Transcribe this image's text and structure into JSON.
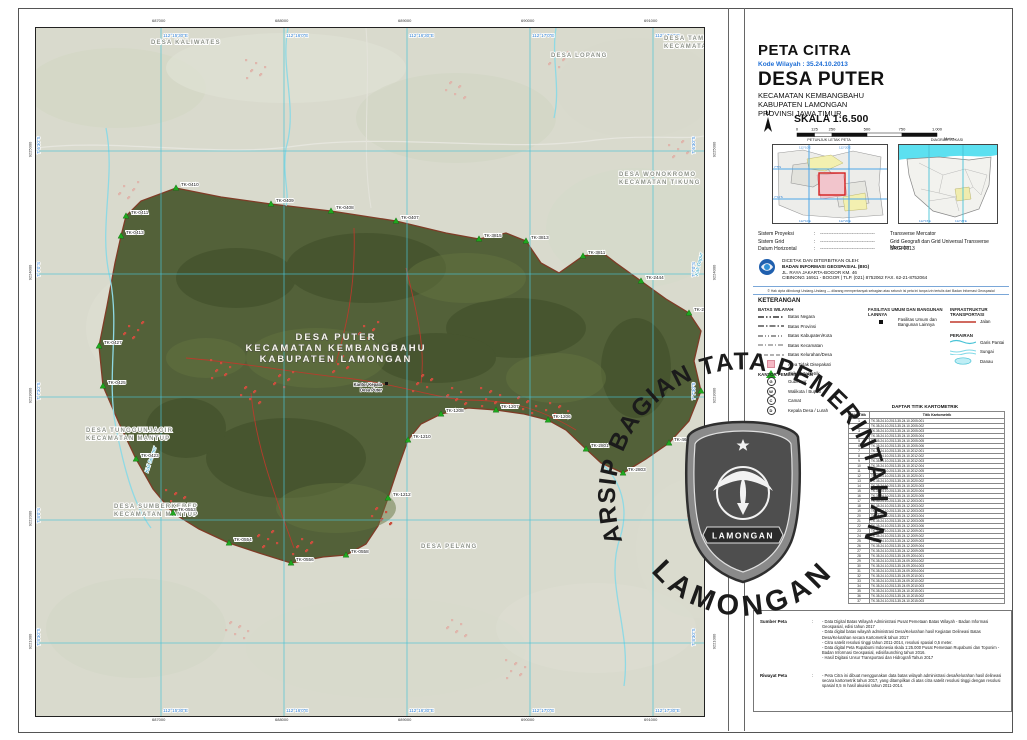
{
  "title_block": {
    "map_type": "PETA CITRA",
    "kode_wilayah": "Kode Wilayah : 35.24.10.2013",
    "village": "DESA PUTER",
    "admin1": "KECAMATAN KEMBANGBAHU",
    "admin2": "KABUPATEN LAMONGAN",
    "admin3": "PROVINSI JAWA TIMUR",
    "north_label": "U",
    "scale_label": "SKALA  1:6.500",
    "scale_unit": "Meter",
    "scale_values": [
      "0",
      "125",
      "250",
      "500",
      "750",
      "1.000"
    ]
  },
  "insets": {
    "left_caption": "PETUNJUK LETAK PETA",
    "right_caption": "DIAGRAM LOKASI"
  },
  "projection": [
    {
      "label": "Sistem Proyeksi",
      "value": "Transverse Mercator"
    },
    {
      "label": "Sistem Grid",
      "value": "Grid Geografi dan Grid Universal Transverse Mercator"
    },
    {
      "label": "Datum Horizontal",
      "value": "SRGI 2013"
    }
  ],
  "publisher": {
    "line1": "DICETAK DAN DITERBITKAN OLEH:",
    "line2": "BADAN INFORMASI GEOSPASIAL (BIG)",
    "line3": "JL. RAYA JAKARTA-BOGOR KM. 46",
    "line4": "CIBINONG 16911 - BOGOR | TLP. (021) 8752062  FAX. 62-21-8752064",
    "copyright": "© Hak cipta dilindungi Undang-Undang — dilarang memperbanyak sebagian atau seluruh isi peta ini tanpa izin tertulis dari Badan Informasi Geospasial"
  },
  "legend": {
    "title": "KETERANGAN",
    "batas_title": "BATAS WILAYAH",
    "batas_items": [
      "Batas Negara",
      "Batas Provinsi",
      "Batas Kabupaten/Kota",
      "Batas Kecamatan",
      "Batas Kelurahan/Desa",
      "Area Tidak Disepakati",
      "Titik Kartometrik"
    ],
    "fasilitas_title": "FASILITAS UMUM DAN BANGUNAN LAINNYA",
    "fasilitas_items": [
      "Fasilitas Umum dan Bangunan Lainnya"
    ],
    "infra_title": "INFRASTRUKTUR TRANSPORTASI",
    "infra_items": [
      "Jalan"
    ],
    "perairan_title": "PERAIRAN",
    "perairan_items": [
      "Garis Pantai",
      "Sungai",
      "Danau"
    ],
    "kantor_title": "KANTOR PEMERINTAHAN",
    "kantor_items": [
      "Gubernur",
      "Walikota / Bupati",
      "Camat",
      "Kepala Desa / Lurah"
    ]
  },
  "table": {
    "title": "DAFTAR TITIK KARTOMETRIK",
    "col_no": "No. Titik",
    "col_name": "Titik Kartometrik",
    "rows": [
      "TK.35.24.10.2013-35.24.10.2005.001",
      "TK.35.24.10.2013-35.24.10.2005.002",
      "TK.35.24.10.2013-35.24.10.2005.003",
      "TK.35.24.10.2013-35.24.10.2005.004",
      "TK.35.24.10.2013-35.24.10.2005.005",
      "TK.35.24.10.2013-35.24.10.2005.006",
      "TK.35.24.10.2013-35.24.10.2012.001",
      "TK.35.24.10.2013-35.24.10.2012.002",
      "TK.35.24.10.2013-35.24.10.2012.003",
      "TK.35.24.10.2013-35.24.10.2012.004",
      "TK.35.24.10.2013-35.24.10.2012.005",
      "TK.35.24.10.2013-35.24.10.2020.001",
      "TK.35.24.10.2013-35.24.10.2020.002",
      "TK.35.24.10.2013-35.24.10.2020.003",
      "TK.35.24.10.2013-35.24.10.2020.004",
      "TK.35.24.10.2013-35.24.10.2020.005",
      "TK.35.24.10.2013-35.24.12.2003.001",
      "TK.35.24.10.2013-35.24.12.2003.002",
      "TK.35.24.10.2013-35.24.12.2003.003",
      "TK.35.24.10.2013-35.24.12.2003.004",
      "TK.35.24.10.2013-35.24.12.2003.005",
      "TK.35.24.10.2013-35.24.12.2003.006",
      "TK.35.24.10.2013-35.24.12.2009.001",
      "TK.35.24.10.2013-35.24.12.2009.002",
      "TK.35.24.10.2013-35.24.12.2009.003",
      "TK.35.24.10.2013-35.24.12.2009.004",
      "TK.35.24.10.2013-35.24.12.2009.005",
      "TK.35.24.10.2013-35.24.09.2004.001",
      "TK.35.24.10.2013-35.24.09.2004.002",
      "TK.35.24.10.2013-35.24.09.2004.003",
      "TK.35.24.10.2013-35.24.09.2004.004",
      "TK.35.24.10.2013-35.24.09.2010.001",
      "TK.35.24.10.2013-35.24.09.2010.002",
      "TK.35.24.10.2013-35.24.09.2010.003",
      "TK.35.24.10.2013-35.24.10.2015.001",
      "TK.35.24.10.2013-35.24.10.2015.002",
      "TK.35.24.10.2013-35.24.10.2015.003"
    ]
  },
  "notes": {
    "sumber_label": "Sumber Peta",
    "riwayat_label": "Riwayat Peta",
    "sumber_items": [
      "Data Digital Batas Wilayah Administrasi Pusat Pemetaan Batas Wilayah - Badan Informasi Geospasial, edisi tahun 2017",
      "Data digital batas wilayah administrasi Desa/Kelurahan hasil Kegiatan Delineasi Batas Desa/Kelurahan secara Kartometrik tahun 2017",
      "Citra satelit resolusi tinggi tahun 2011-2014, resolusi spasial 0,5 meter.",
      "Data digital Peta Rupabumi Indonesia skala 1:25.000 Pusat Pemetaan Rupabumi dan Toponim - Badan Informasi Geospasial, edisi/launching tahun 2016.",
      "Hasil Digitasi Unsur Transportasi dan Hidrografi Tahun 2017"
    ],
    "riwayat_items": [
      "Peta Citra ini dibuat menggunakan data batas wilayah administrasi desa/kelurahan hasil delineasi secara kartometrik tahun 2017, yang ditampilkan di atas citra satelit resolusi tinggi dengan resolusi spasial 0,5 m hasil akuisisi tahun 2011-2014."
    ]
  },
  "watermark": {
    "arc_top": "ARSIP BAGIAN TATA PEMERINTAHAN",
    "arc_bottom": "LAMONGAN",
    "banner": "LAMONGAN"
  },
  "map": {
    "center_label": [
      "DESA PUTER",
      "KECAMATAN KEMBANGBAHU",
      "KABUPATEN LAMONGAN"
    ],
    "poi": {
      "x": 346,
      "y": 358,
      "lines": [
        "Kantor Kepala",
        "Desa Puter"
      ]
    },
    "village_polygon": "90,188 105,173 140,160 185,169 235,176 295,183 360,193 410,205 443,211 470,205 490,213 505,235 523,245 547,228 567,225 580,235 605,253 630,271 653,285 665,303 658,333 665,363 653,393 633,415 610,431 587,445 565,435 550,421 530,402 512,392 488,386 460,382 432,380 405,386 385,396 372,412 362,440 352,470 342,498 330,516 310,527 287,529 255,535 223,525 193,515 163,501 137,485 117,461 100,431 83,395 67,358 63,318 71,278 79,235 85,208",
    "grid_v": [
      {
        "x": 125,
        "label": "112°15′30″E"
      },
      {
        "x": 248,
        "label": "112°16′0″E"
      },
      {
        "x": 371,
        "label": "112°16′30″E"
      },
      {
        "x": 494,
        "label": "112°17′0″E"
      },
      {
        "x": 617,
        "label": "112°17′30″E"
      }
    ],
    "grid_h": [
      {
        "y": 123,
        "label": "7°6′30″S"
      },
      {
        "y": 246,
        "label": "7°7′0″S"
      },
      {
        "y": 369,
        "label": "7°7′30″S"
      },
      {
        "y": 492,
        "label": "7°8′0″S"
      },
      {
        "y": 615,
        "label": "7°8′30″S"
      }
    ],
    "utm_top": [
      "687000",
      "688000",
      "689000",
      "690000",
      "691000"
    ],
    "utm_left": [
      "9225000",
      "9224000",
      "9223000",
      "9222000",
      "9221000"
    ],
    "neighbor_labels": [
      {
        "x": 115,
        "y": 16,
        "lines": [
          "DESA KALIWATES"
        ]
      },
      {
        "x": 515,
        "y": 29,
        "lines": [
          "DESA LOPANG"
        ]
      },
      {
        "x": 628,
        "y": 12,
        "lines": [
          "DESA TAMBAKRIGADUNG",
          "KECAMATAN TIKUNG"
        ]
      },
      {
        "x": 583,
        "y": 148,
        "lines": [
          "DESA WONOKROMO",
          "KECAMATAN TIKUNG"
        ]
      },
      {
        "x": 50,
        "y": 404,
        "lines": [
          "DESA TUNGGUNJAGIR",
          "KECAMATAN MANTUP"
        ]
      },
      {
        "x": 78,
        "y": 480,
        "lines": [
          "DESA SUMBERKEREP",
          "KECAMATAN MANTUP"
        ]
      },
      {
        "x": 385,
        "y": 520,
        "lines": [
          "DESA PELANG"
        ]
      }
    ],
    "river_labels": [
      {
        "x": 112,
        "y": 445,
        "rot": -72,
        "text": "Kali Semper"
      },
      {
        "x": 662,
        "y": 248,
        "rot": -78,
        "text": "Kali Dapur"
      }
    ],
    "tk_points": [
      {
        "x": 85,
        "y": 208,
        "label": "TK-0413"
      },
      {
        "x": 90,
        "y": 188,
        "label": "TK-0411"
      },
      {
        "x": 140,
        "y": 160,
        "label": "TK-0410"
      },
      {
        "x": 235,
        "y": 176,
        "label": "TK-0409"
      },
      {
        "x": 295,
        "y": 183,
        "label": "TK-0408"
      },
      {
        "x": 360,
        "y": 193,
        "label": "TK-0407"
      },
      {
        "x": 443,
        "y": 211,
        "label": "TK-3815"
      },
      {
        "x": 490,
        "y": 213,
        "label": "TK-3813"
      },
      {
        "x": 547,
        "y": 228,
        "label": "TK-3811"
      },
      {
        "x": 605,
        "y": 253,
        "label": "TK-2444"
      },
      {
        "x": 653,
        "y": 285,
        "label": "TK-2443"
      },
      {
        "x": 665,
        "y": 363,
        "label": "TK-4613"
      },
      {
        "x": 633,
        "y": 415,
        "label": "TK-4611"
      },
      {
        "x": 587,
        "y": 445,
        "label": "TK-2803"
      },
      {
        "x": 550,
        "y": 421,
        "label": "TK-2801"
      },
      {
        "x": 512,
        "y": 392,
        "label": "TK-1206"
      },
      {
        "x": 460,
        "y": 382,
        "label": "TK-1207"
      },
      {
        "x": 405,
        "y": 386,
        "label": "TK-1208"
      },
      {
        "x": 372,
        "y": 412,
        "label": "TK-1210"
      },
      {
        "x": 352,
        "y": 470,
        "label": "TK-1212"
      },
      {
        "x": 310,
        "y": 527,
        "label": "TK-0558"
      },
      {
        "x": 255,
        "y": 535,
        "label": "TK-0556"
      },
      {
        "x": 193,
        "y": 515,
        "label": "TK-0554"
      },
      {
        "x": 137,
        "y": 485,
        "label": "TK-0553"
      },
      {
        "x": 100,
        "y": 431,
        "label": "TK-0423"
      },
      {
        "x": 67,
        "y": 358,
        "label": "TK-0425"
      },
      {
        "x": 63,
        "y": 318,
        "label": "TK-0427"
      }
    ],
    "colors": {
      "village": "#4b5a30",
      "grid": "#49c3d6",
      "coord_text": "#2f7fd2",
      "road": "#c0392b",
      "water": "#7fd8e6",
      "tk": "#1fa81f",
      "label": "#8d9288"
    }
  }
}
